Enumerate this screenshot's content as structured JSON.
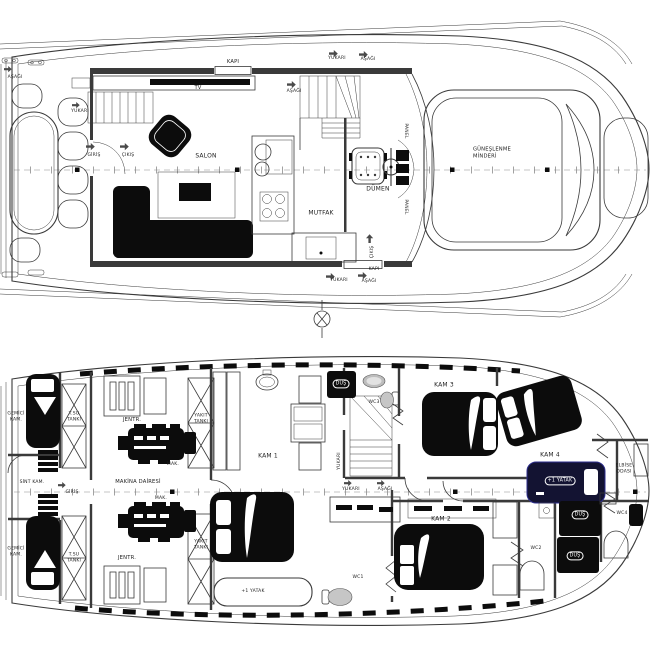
{
  "colors": {
    "line": "#3a3a3a",
    "black_fill": "#0c0c0c",
    "navy_fill": "#131332",
    "gray_fixture": "#c6c6c6",
    "paper": "#ffffff"
  },
  "upper": {
    "asagi_transom": "AŞAĞI",
    "yukari_side": "YUKARI",
    "kapi_top": "KAPI",
    "tv": "TV",
    "asagi_stair": "AŞAĞI",
    "yukari_companion": "YUKARI",
    "asagi_companion": "AŞAĞI",
    "giris": "GİRİŞ",
    "cikis": "ÇIKIŞ",
    "salon": "SALON",
    "mutfak": "MUTFAK",
    "dumen": "DÜMEN",
    "panel_top": "PANEL",
    "panel_bottom": "PANEL",
    "sunpad": "GÜNEŞLENME\nMİNDERİ",
    "cikis_door": "ÇIKIŞ",
    "kapi_bottom": "KAPI",
    "yukari_bottom": "YUKARI",
    "asagi_bott om_x": "",
    "asagi_bottom": "AŞAĞI"
  },
  "lower": {
    "gemici_top": "GEMİCİ\nKAM.",
    "tsu_top": "T.SU\nTANKI",
    "sint_kam": "SİNT KAM.",
    "giris": "GİRİŞ",
    "jentr_top": "JENTR.",
    "yakit_top": "YAKIT\nTANKI",
    "mak_top": "MAK.",
    "makina_dairesi": "MAKİNA DAİRESİ",
    "mak_bottom": "MAK.",
    "yakit_bottom": "YAKIT\nTANKI",
    "jentr_bottom": "JENTR.",
    "tsu_bottom": "T.SU\nTANKI",
    "gemici_bottom": "GEMİCİ\nKAM.",
    "kam1": "KAM 1",
    "kam2": "KAM 2",
    "kam3": "KAM 3",
    "kam4": "KAM 4",
    "wc1": "WC1",
    "wc2": "WC2",
    "wc3": "WC3",
    "wc4": "WC4",
    "dus_wc1": "DUŞ",
    "dus_wc2": "DUŞ",
    "dus_wc3": "DUŞ",
    "dus_wc4": "DUŞ",
    "elbise": "ELBİSE\nODASI",
    "yatak_kam1": "+1 YATAK",
    "yatak_kam4": "+1 YATAK",
    "yukari_stair": "YUKARI",
    "yukari_cl": "YUKARI",
    "asagi_cl": "AŞAĞI"
  }
}
